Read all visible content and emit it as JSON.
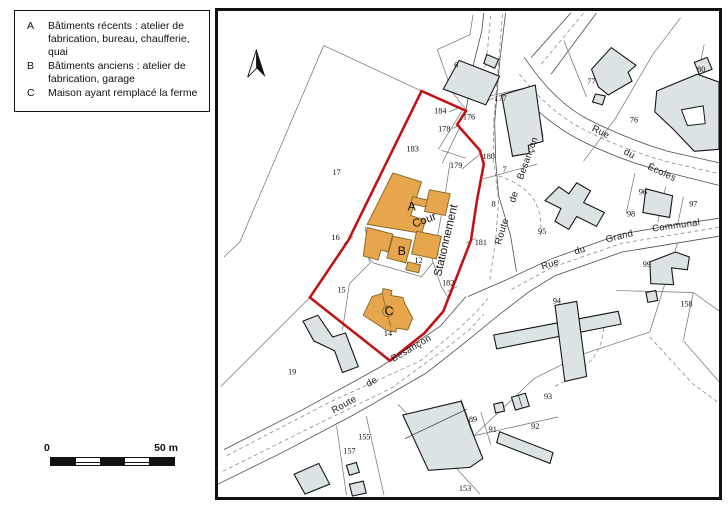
{
  "legend": {
    "items": [
      {
        "letter": "A",
        "text": "Bâtiments récents : atelier de fabrication, bureau, chaufferie, quai"
      },
      {
        "letter": "B",
        "text": "Bâtiments anciens : atelier de fabrication, garage"
      },
      {
        "letter": "C",
        "text": "Maison ayant remplacé la ferme"
      }
    ]
  },
  "scale_bar": {
    "start_label": "0",
    "end_label": "50 m"
  },
  "icons": {
    "north_arrow": "north-pointer-triangle"
  },
  "map": {
    "colors": {
      "building_recent": "#E7A64D",
      "building_other": "#DCE3E5",
      "site_outline": "#C11216",
      "parcel_line": "#6F6F6F",
      "road_line": "#8A8A8A"
    },
    "parcel_numbers": [
      {
        "n": "6",
        "x": 456,
        "y": 65
      },
      {
        "n": "17",
        "x": 335,
        "y": 174
      },
      {
        "n": "183",
        "x": 412,
        "y": 150
      },
      {
        "n": "184",
        "x": 440,
        "y": 112
      },
      {
        "n": "178",
        "x": 444,
        "y": 130
      },
      {
        "n": "176",
        "x": 469,
        "y": 118
      },
      {
        "n": "179",
        "x": 456,
        "y": 167
      },
      {
        "n": "180",
        "x": 489,
        "y": 158
      },
      {
        "n": "177",
        "x": 501,
        "y": 99
      },
      {
        "n": "7",
        "x": 505,
        "y": 171
      },
      {
        "n": "8",
        "x": 494,
        "y": 206
      },
      {
        "n": "77",
        "x": 593,
        "y": 82
      },
      {
        "n": "76",
        "x": 636,
        "y": 121
      },
      {
        "n": "80",
        "x": 704,
        "y": 70
      },
      {
        "n": "96",
        "x": 645,
        "y": 194
      },
      {
        "n": "97",
        "x": 696,
        "y": 206
      },
      {
        "n": "98",
        "x": 633,
        "y": 216
      },
      {
        "n": "16",
        "x": 334,
        "y": 240
      },
      {
        "n": "181",
        "x": 481,
        "y": 245
      },
      {
        "n": "12",
        "x": 418,
        "y": 263
      },
      {
        "n": "182",
        "x": 448,
        "y": 286
      },
      {
        "n": "15",
        "x": 340,
        "y": 293
      },
      {
        "n": "14",
        "x": 387,
        "y": 337
      },
      {
        "n": "19",
        "x": 290,
        "y": 376
      },
      {
        "n": "95",
        "x": 543,
        "y": 234
      },
      {
        "n": "94",
        "x": 558,
        "y": 304
      },
      {
        "n": "99",
        "x": 649,
        "y": 267
      },
      {
        "n": "158",
        "x": 689,
        "y": 307
      },
      {
        "n": "93",
        "x": 549,
        "y": 401
      },
      {
        "n": "89",
        "x": 473,
        "y": 424
      },
      {
        "n": "91",
        "x": 493,
        "y": 434
      },
      {
        "n": "92",
        "x": 536,
        "y": 431
      },
      {
        "n": "155",
        "x": 363,
        "y": 442
      },
      {
        "n": "157",
        "x": 348,
        "y": 456
      },
      {
        "n": "153",
        "x": 465,
        "y": 494
      }
    ],
    "street_names": [
      {
        "text": "Route",
        "x": 505,
        "y": 232,
        "rot": -73
      },
      {
        "text": "de",
        "x": 517,
        "y": 197,
        "rot": -72
      },
      {
        "text": "Besançon",
        "x": 531,
        "y": 158,
        "rot": -70
      },
      {
        "text": "Route",
        "x": 344,
        "y": 409,
        "rot": -29
      },
      {
        "text": "de",
        "x": 372,
        "y": 386,
        "rot": -30
      },
      {
        "text": "Besançon",
        "x": 412,
        "y": 352,
        "rot": -30
      },
      {
        "text": "Rue",
        "x": 601,
        "y": 133,
        "rot": 27
      },
      {
        "text": "du",
        "x": 630,
        "y": 155,
        "rot": 27
      },
      {
        "text": "Écoles",
        "x": 663,
        "y": 174,
        "rot": 25
      },
      {
        "text": "Rue",
        "x": 552,
        "y": 267,
        "rot": -17
      },
      {
        "text": "du",
        "x": 582,
        "y": 253,
        "rot": -17
      },
      {
        "text": "Grand",
        "x": 622,
        "y": 239,
        "rot": -14
      },
      {
        "text": "Communal",
        "x": 679,
        "y": 228,
        "rot": -8
      }
    ],
    "area_labels": [
      {
        "text": "Cour",
        "x": 425,
        "y": 223,
        "rot": -21,
        "size": 11.5
      },
      {
        "text": "Stationnement",
        "x": 449,
        "y": 241,
        "rot": -77,
        "size": 11.5
      }
    ],
    "building_labels": [
      {
        "text": "A",
        "x": 411,
        "y": 210
      },
      {
        "text": "B",
        "x": 401,
        "y": 255
      },
      {
        "text": "C",
        "x": 388,
        "y": 316
      }
    ]
  }
}
